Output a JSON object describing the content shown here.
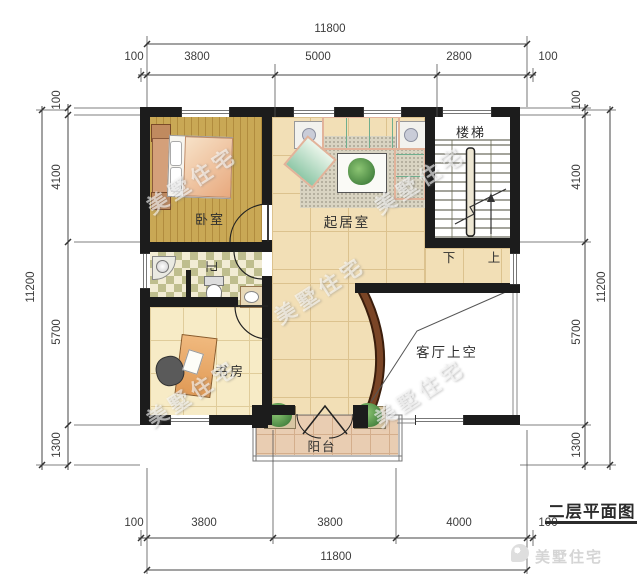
{
  "title": "二层平面图",
  "brand": {
    "logo_text": "美墅住宅"
  },
  "watermark": "美墅住宅",
  "rooms": {
    "bedroom": "卧室",
    "living": "起居室",
    "stairs": "楼梯",
    "bath": "卫",
    "study": "书房",
    "void": "客厅上空",
    "balcony": "阳台",
    "down": "下",
    "up": "上"
  },
  "dimensions": {
    "top": {
      "total": "11800",
      "segments": [
        "100",
        "3800",
        "5000",
        "2800",
        "100"
      ]
    },
    "bottom": {
      "total": "11800",
      "segments": [
        "100",
        "3800",
        "3800",
        "4000",
        "100"
      ]
    },
    "left": {
      "total": "11200",
      "segments": [
        "100",
        "4100",
        "5700",
        "1300"
      ]
    },
    "right": {
      "total": "11200",
      "segments": [
        "100",
        "4100",
        "5700",
        "1300"
      ]
    }
  },
  "colors": {
    "wall": "#1C1C1C",
    "tile": "#F2DFB6",
    "wood_floor": "#C9A855",
    "stairs": "#C3AD7F",
    "curved_wall": "#7A4526",
    "balcony_tile": "#E9CDB2"
  }
}
